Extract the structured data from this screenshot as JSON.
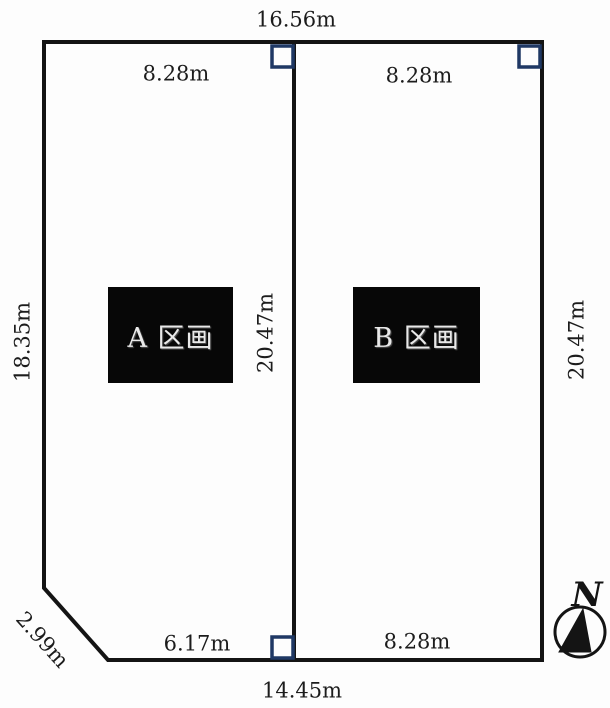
{
  "canvas": {
    "background": "#fdfdfd",
    "line_color": "#141414",
    "marker_color": "#1f3864",
    "text_color": "#1c1c1c",
    "plot_box_bg": "#070707",
    "plot_box_text": "#e9e9e9"
  },
  "plots": {
    "a": {
      "label": "A 区画"
    },
    "b": {
      "label": "B 区画"
    }
  },
  "dimensions": {
    "top_total": "16.56m",
    "top_a": "8.28m",
    "top_b": "8.28m",
    "left_side": "18.35m",
    "center_divider": "20.47m",
    "right_side": "20.47m",
    "diagonal_corner": "2.99m",
    "bottom_a": "6.17m",
    "bottom_b": "8.28m",
    "bottom_total": "14.45m"
  },
  "compass": {
    "label": "N"
  }
}
